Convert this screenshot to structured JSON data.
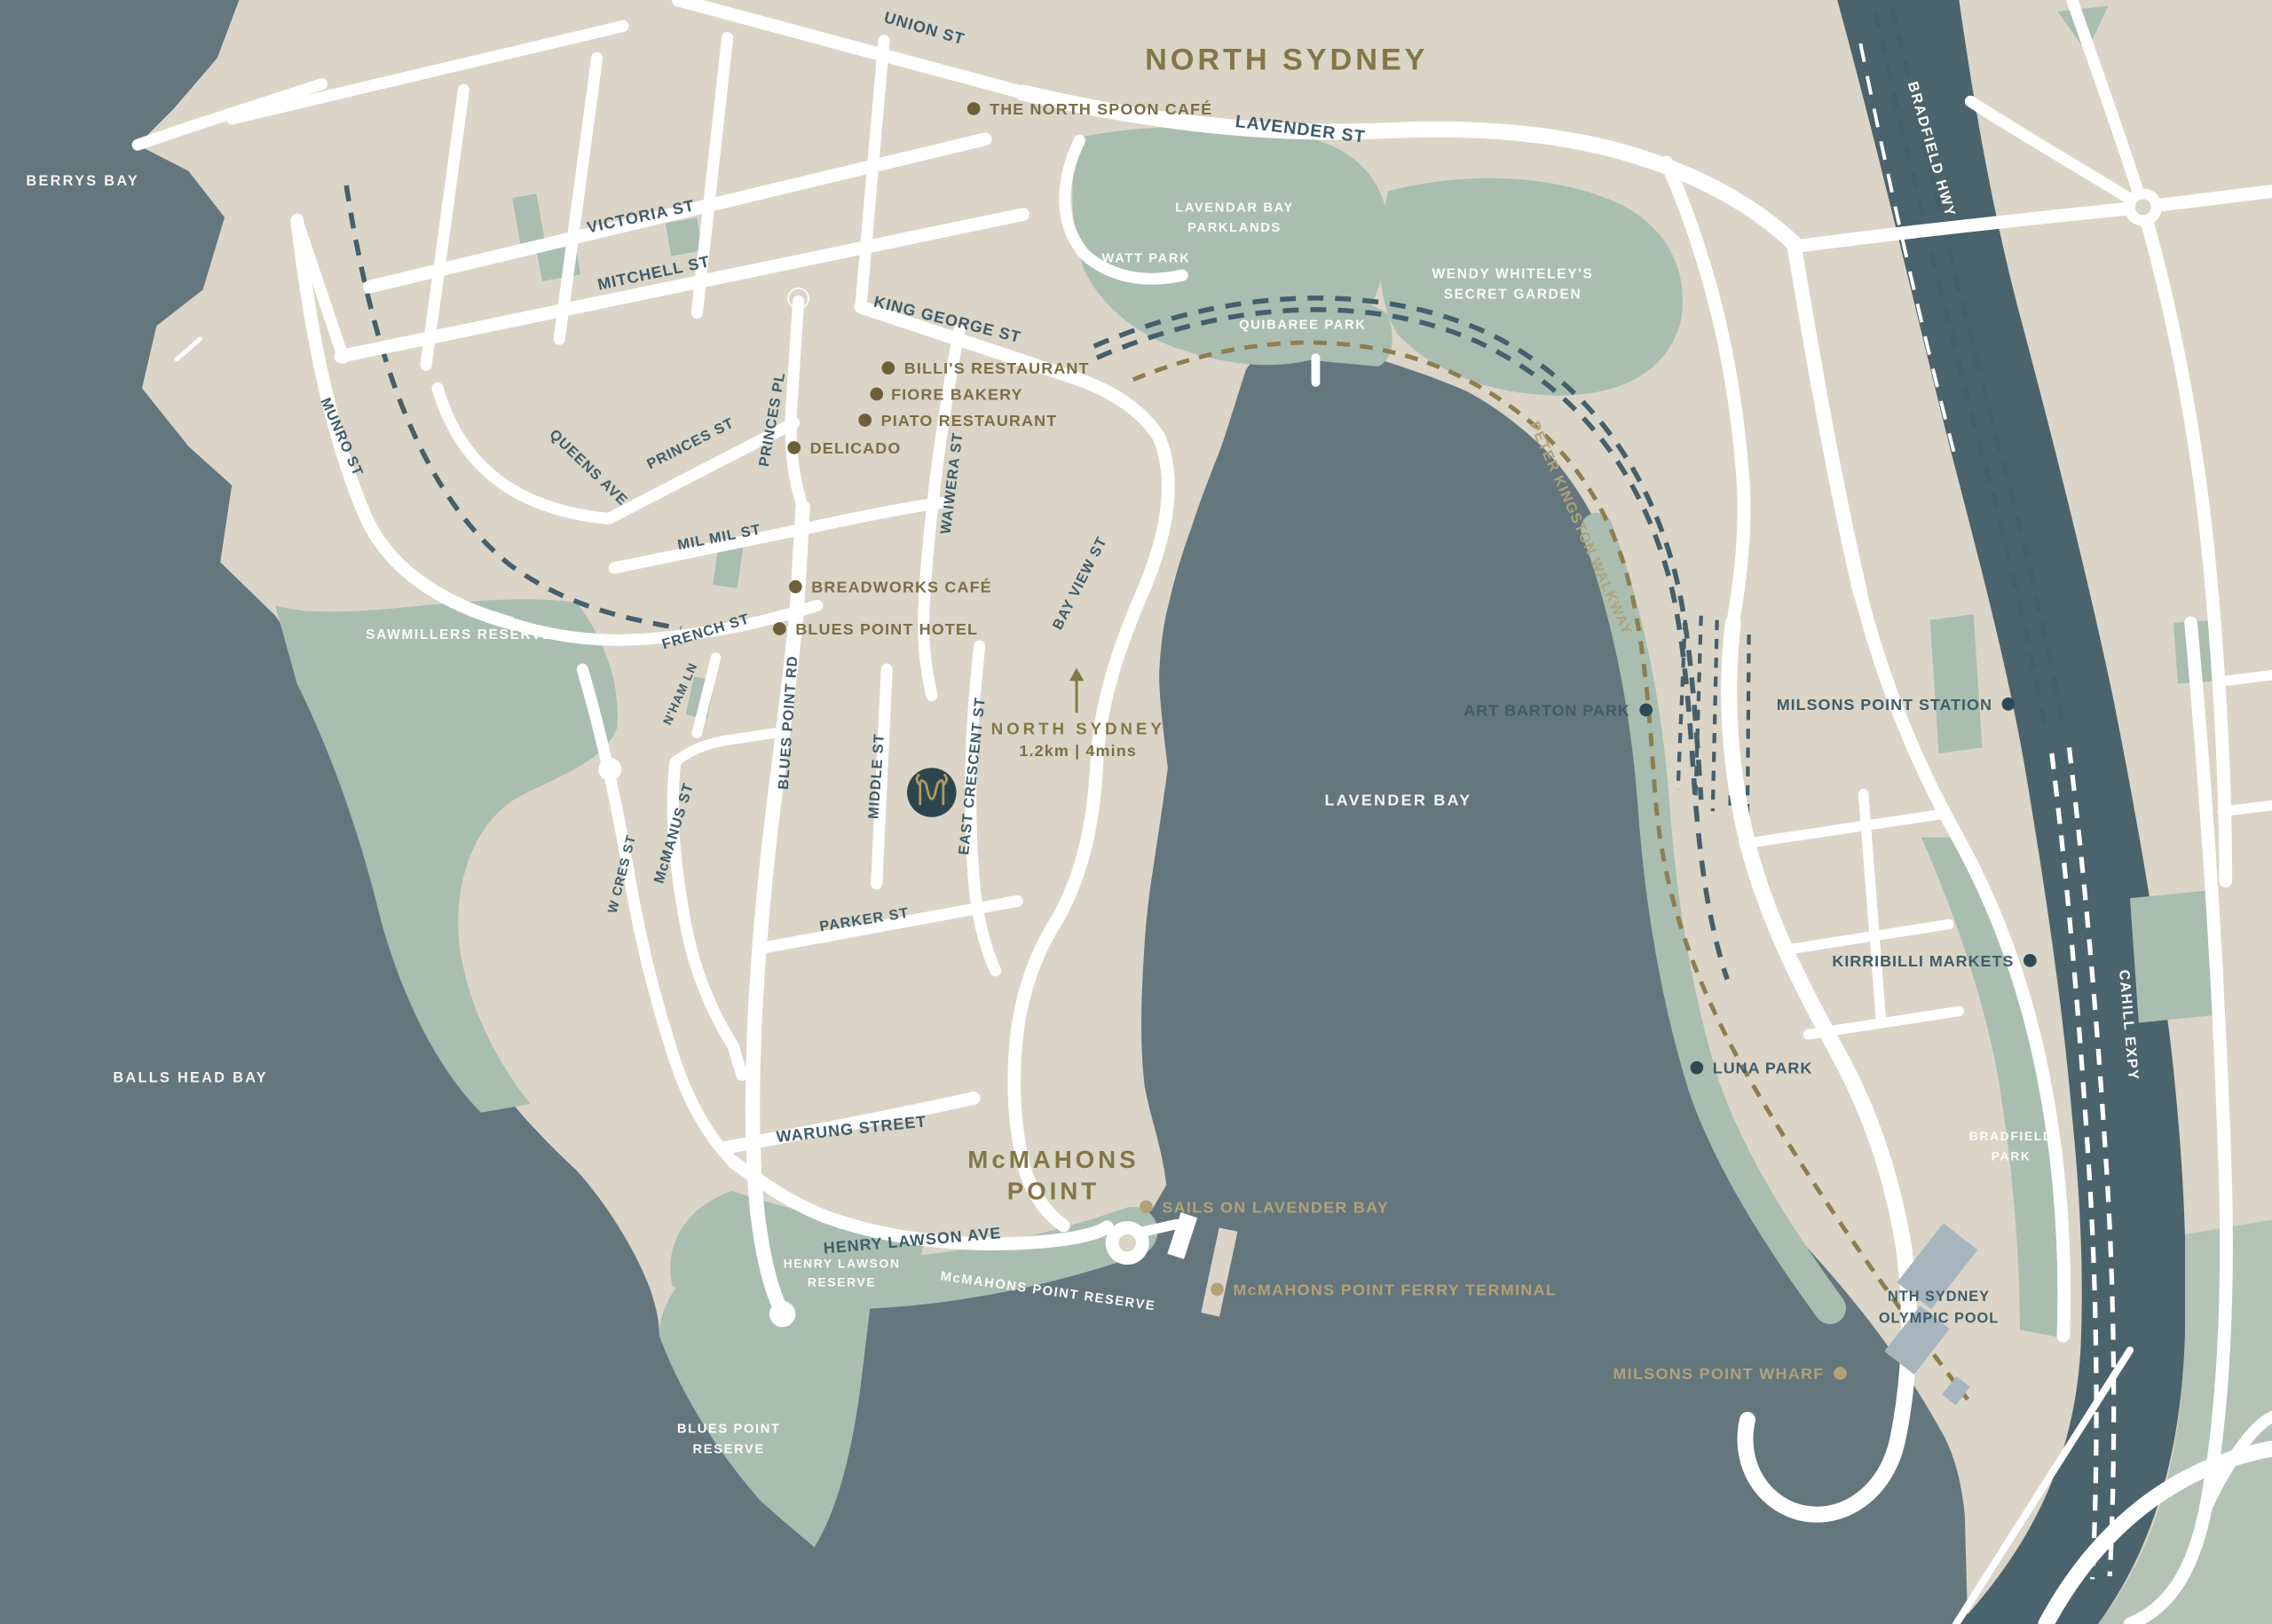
{
  "map": {
    "region_labels": {
      "north_sydney": "NORTH SYDNEY",
      "mcmahons_line1": "McMAHONS",
      "mcmahons_line2": "POINT"
    },
    "water_labels": {
      "berrys": "BERRYS BAY",
      "balls_head": "BALLS HEAD BAY",
      "lavender": "LAVENDER BAY"
    },
    "distance_marker": {
      "destination": "NORTH SYDNEY",
      "detail": "1.2km | 4mins"
    },
    "streets": [
      {
        "label": "UNION ST"
      },
      {
        "label": "LAVENDER ST"
      },
      {
        "label": "VICTORIA ST"
      },
      {
        "label": "MITCHELL ST"
      },
      {
        "label": "KING GEORGE ST"
      },
      {
        "label": "PRINCES PL"
      },
      {
        "label": "PRINCES ST"
      },
      {
        "label": "QUEENS AVE"
      },
      {
        "label": "MUNRO ST"
      },
      {
        "label": "MIL MIL ST"
      },
      {
        "label": "WAIWERA ST"
      },
      {
        "label": "BAY VIEW ST"
      },
      {
        "label": "FRENCH ST"
      },
      {
        "label": "N'HAM LN"
      },
      {
        "label": "BLUES POINT RD"
      },
      {
        "label": "McMANUS ST"
      },
      {
        "label": "W CRES ST"
      },
      {
        "label": "MIDDLE ST"
      },
      {
        "label": "EAST CRESCENT ST"
      },
      {
        "label": "PARKER ST"
      },
      {
        "label": "WARUNG STREET"
      },
      {
        "label": "HENRY LAWSON AVE"
      },
      {
        "label": "BRADFIELD HWY"
      },
      {
        "label": "CAHILL EXPY"
      }
    ],
    "walkway_label": "PETER KINGSTON WALKWAY",
    "pois": [
      {
        "label": "THE NORTH SPOON CAFÉ"
      },
      {
        "label": "BILLI'S RESTAURANT"
      },
      {
        "label": "FIORE BAKERY"
      },
      {
        "label": "PIATO RESTAURANT"
      },
      {
        "label": "DELICADO"
      },
      {
        "label": "BREADWORKS CAFÉ"
      },
      {
        "label": "BLUES POINT HOTEL"
      },
      {
        "label": "SAILS ON LAVENDER BAY"
      },
      {
        "label": "McMAHONS POINT FERRY TERMINAL"
      },
      {
        "label": "MILSONS POINT WHARF"
      },
      {
        "label": "ART BARTON PARK"
      },
      {
        "label": "MILSONS POINT STATION"
      },
      {
        "label": "KIRRIBILLI MARKETS"
      },
      {
        "label": "LUNA PARK"
      }
    ],
    "landmark_labels": [
      {
        "text": "NTH SYDNEY"
      },
      {
        "text": "OLYMPIC POOL"
      }
    ],
    "park_labels": [
      {
        "text": "LAVENDAR BAY"
      },
      {
        "text": "PARKLANDS"
      },
      {
        "text": "WATT PARK"
      },
      {
        "text": "WENDY WHITELEY'S"
      },
      {
        "text": "SECRET GARDEN"
      },
      {
        "text": "QUIBAREE PARK"
      },
      {
        "text": "SAWMILLERS RESERVE"
      },
      {
        "text": "HENRY LAWSON"
      },
      {
        "text": "RESERVE"
      },
      {
        "text": "McMAHONS POINT RESERVE"
      },
      {
        "text": "BLUES POINT"
      },
      {
        "text": "RESERVE"
      },
      {
        "text": "BRADFIELD"
      },
      {
        "text": "PARK"
      }
    ],
    "logo_monogram": "M",
    "colors": {
      "water": "#64767E",
      "land": "#DBD5C8",
      "park_green": "#A9BEB1",
      "road_white": "#FFFFFF",
      "street_text": "#3F5C69",
      "poi_gold": "#7D6E45",
      "poi_gold_light": "#B2A277",
      "area_title_gold": "#857647",
      "highway_band": "#4B636D",
      "railway_slate": "#455F6B",
      "logo_background": "#2C464F",
      "logo_gold": "#B19A5F",
      "building_bluegrey": "#A7B5BF"
    }
  }
}
